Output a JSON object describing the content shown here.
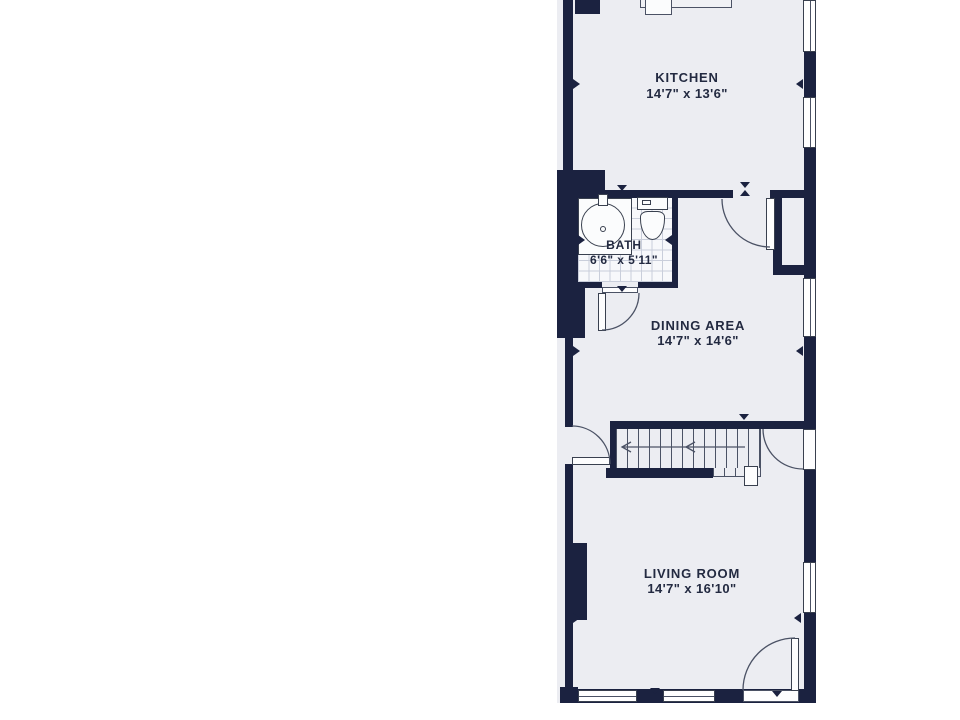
{
  "type": "floor_plan",
  "rooms": {
    "kitchen": {
      "name": "KITCHEN",
      "dims": "14'7\" x 13'6\""
    },
    "bath": {
      "name": "BATH",
      "dims": "6'6\" x 5'11\""
    },
    "dining": {
      "name": "DINING AREA",
      "dims": "14'7\" x 14'6\""
    },
    "living": {
      "name": "LIVING ROOM",
      "dims": "14'7\" x 16'10\""
    }
  },
  "colors": {
    "wall": "#1b2240",
    "floor": "#ecedf2",
    "bath_floor": "#f7f8fb",
    "grid": "#c9cedb",
    "line": "#4b5265",
    "outline": "#39404f",
    "text": "#232a41",
    "page_bg": "#ffffff"
  }
}
